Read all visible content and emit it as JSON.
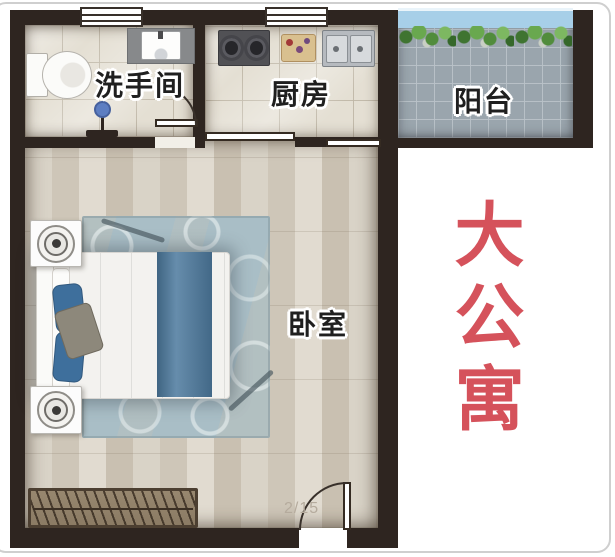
{
  "caption": {
    "text": "大公寓",
    "color": "#d5525b"
  },
  "rooms": {
    "bathroom": {
      "label": "洗手间"
    },
    "kitchen": {
      "label": "厨房"
    },
    "balcony": {
      "label": "阳台"
    },
    "bedroom": {
      "label": "卧室"
    }
  },
  "watermark": {
    "text": "2/15"
  },
  "colors": {
    "wall": "#2e2520",
    "accent_red": "#d5525b",
    "balcony_tile": "#9aa5ad",
    "bathroom_tile": "#e4dfd3",
    "wood_floor": "#d6cfc2",
    "rug": "#a9bec6",
    "bed_runner": "#4d7a9e",
    "balcony_glass": "#a7cfe8"
  },
  "fixtures": [
    "toilet",
    "washbasin",
    "shower-drain",
    "bathroom-door",
    "gas-stove",
    "cutting-board",
    "double-sink",
    "sliding-door",
    "balcony-plants",
    "bed",
    "pillows",
    "nightstands",
    "table-lamps",
    "rug",
    "shoe-bench",
    "entry-door"
  ]
}
